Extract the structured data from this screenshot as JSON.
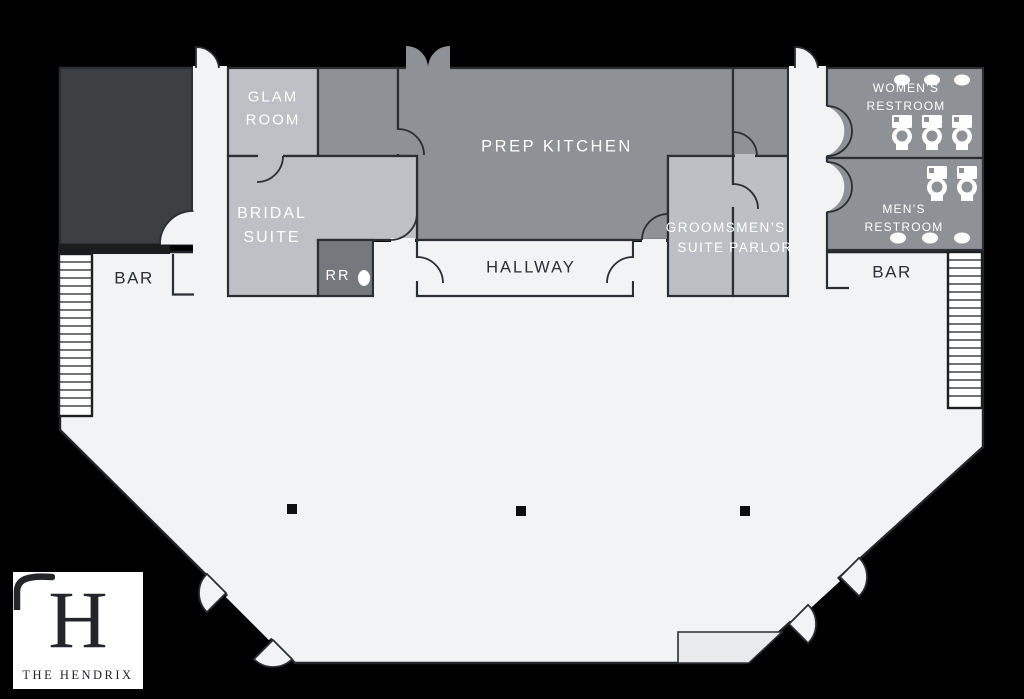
{
  "venue": {
    "monogram": "H",
    "name": "THE HENDRIX"
  },
  "rooms": {
    "glam_room": {
      "label": "GLAM\nROOM"
    },
    "bridal_suite": {
      "label": "BRIDAL\nSUITE"
    },
    "prep_kitchen": {
      "label": "PREP KITCHEN"
    },
    "hallway": {
      "label": "HALLWAY"
    },
    "restroom_rr": {
      "label": "RR"
    },
    "grooms_suite": {
      "label": "GROOMS\nSUITE"
    },
    "mens_parlor": {
      "label": "MEN’S\nPARLOR"
    },
    "womens_restroom": {
      "label": "WOMEN’S RESTROOM",
      "toilets": 3,
      "sinks": 3
    },
    "mens_restroom": {
      "label": "MEN’S RESTROOM",
      "toilets": 2,
      "sinks": 3
    },
    "bar_left": {
      "label": "BAR"
    },
    "bar_right": {
      "label": "BAR"
    }
  },
  "colors": {
    "background": "#000000",
    "wall": "#2b2e32",
    "hall_floor": "#f2f3f5",
    "stage": "#e8eaec",
    "dark_room": "#3d4043",
    "medium_room": "#8e9195",
    "light_room": "#bdc0c4",
    "rr_room": "#75787c",
    "label_white": "#ffffff",
    "label_dark": "#2b2e32"
  }
}
